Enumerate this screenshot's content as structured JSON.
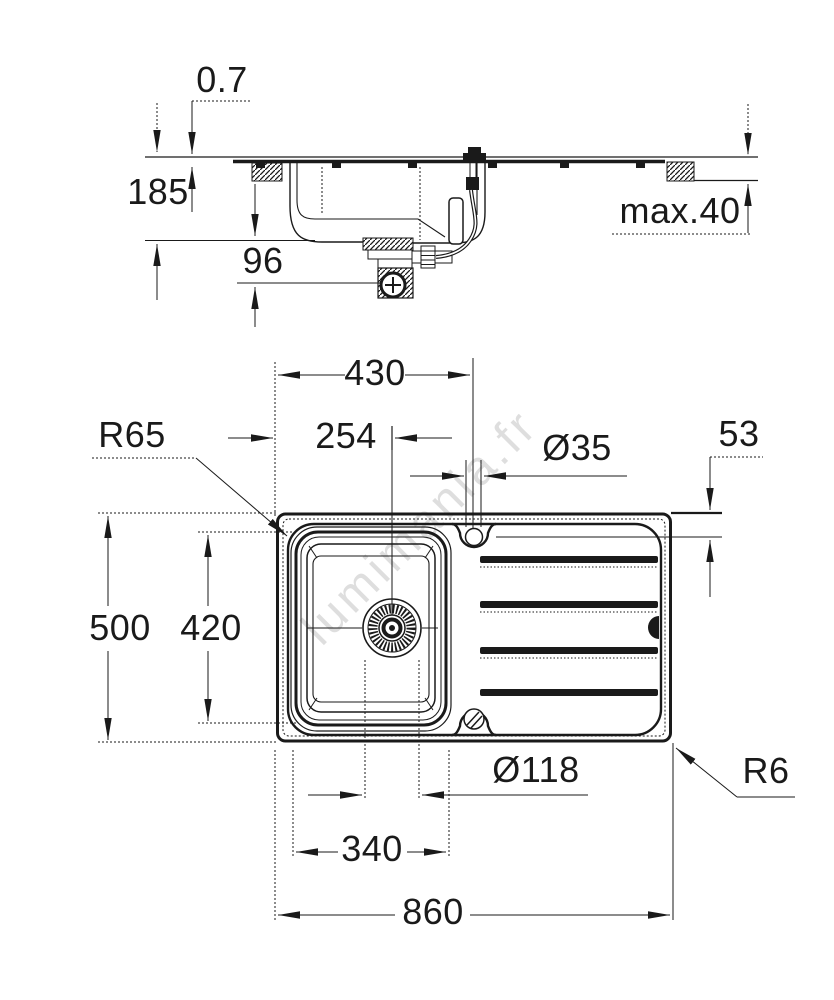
{
  "page": {
    "background": "#ffffff",
    "line_color": "#1a1a1a",
    "watermark_color": "#c9c9c9"
  },
  "watermark": {
    "text": "lumimania.fr"
  },
  "side_view": {
    "dims": {
      "sheet_thickness": {
        "label": "0.7"
      },
      "bowl_depth": {
        "label": "185"
      },
      "trap_clearance": {
        "label": "96"
      },
      "worktop_thickness": {
        "label": "max.40"
      }
    }
  },
  "plan_view": {
    "dims": {
      "tap_center_offset": {
        "label": "430"
      },
      "drain_center_offset": {
        "label": "254"
      },
      "tap_hole_diameter": {
        "label": "Ø35"
      },
      "drainboard_edge_offset": {
        "label": "53"
      },
      "bowl_corner_radius": {
        "label": "R65"
      },
      "overall_depth": {
        "label": "500"
      },
      "bowl_inner_length": {
        "label": "420"
      },
      "drain_diameter": {
        "label": "Ø118"
      },
      "bowl_inner_width": {
        "label": "340"
      },
      "overall_width": {
        "label": "860"
      },
      "outer_corner_radius": {
        "label": "R6"
      }
    }
  }
}
